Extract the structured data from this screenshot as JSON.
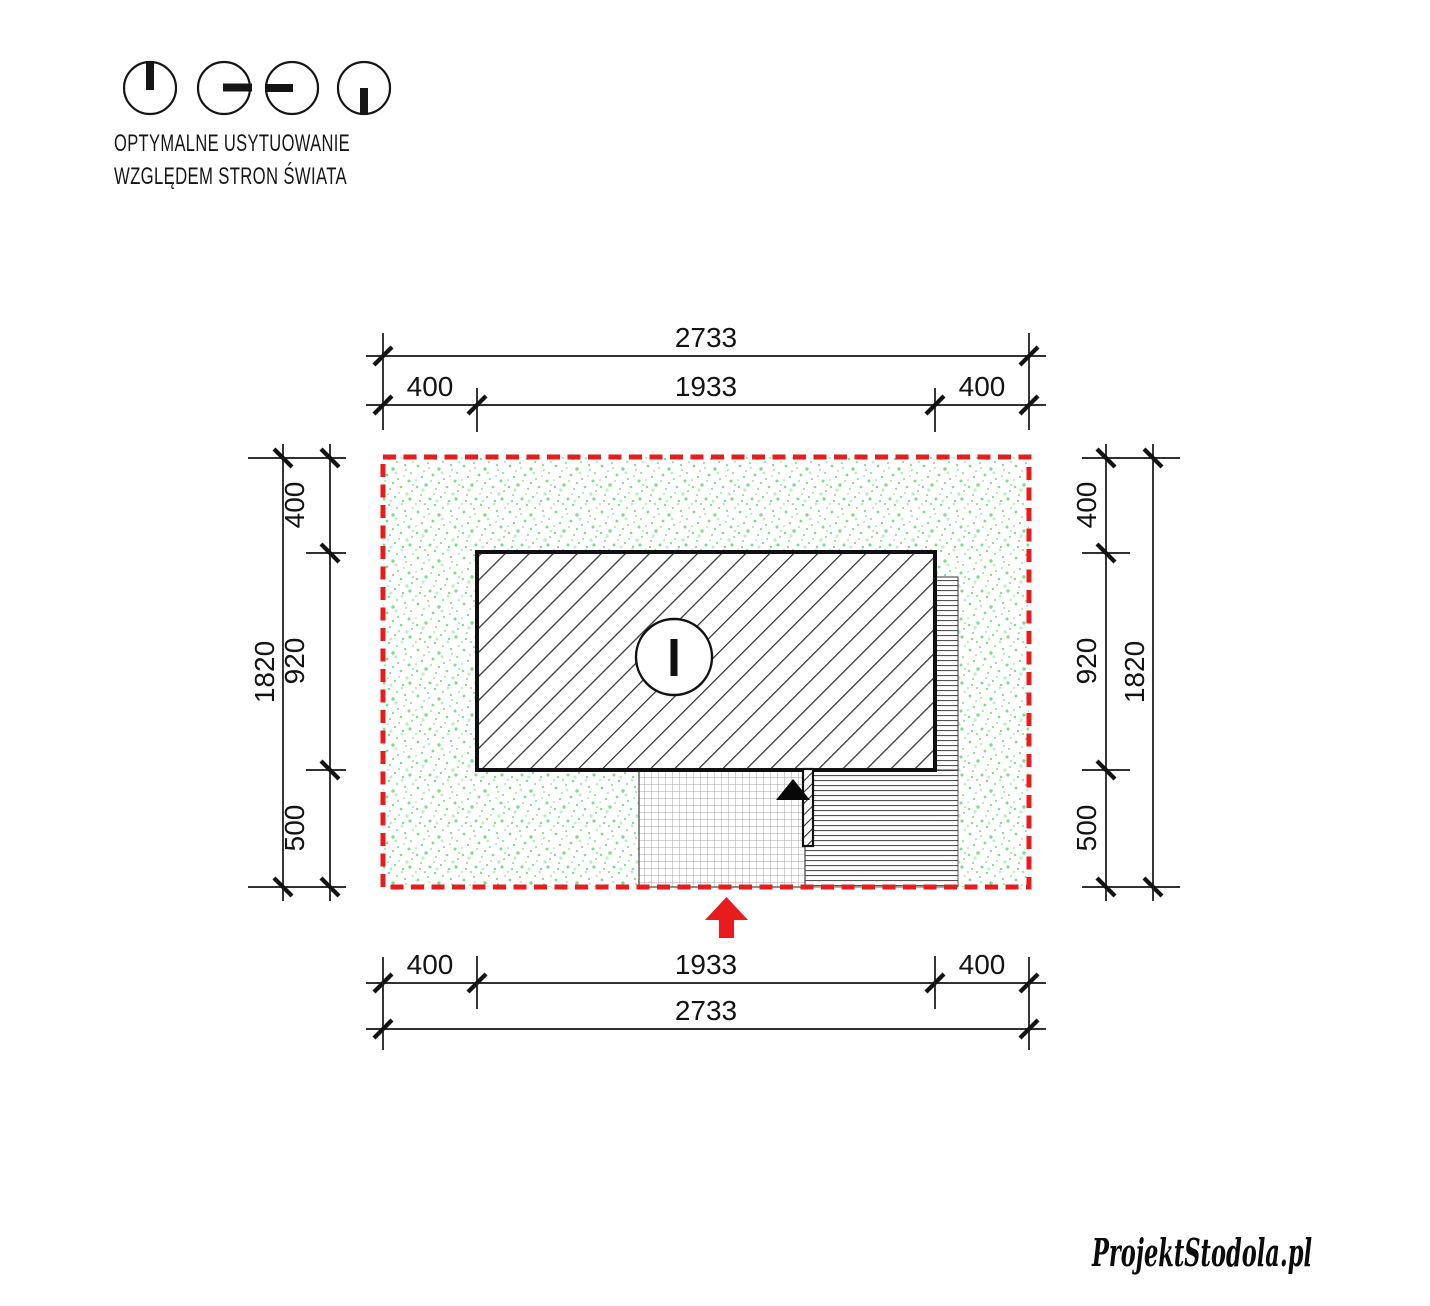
{
  "orientation_legend": {
    "icon_names": [
      "clock-hand-up-icon",
      "clock-hand-right-icon",
      "clock-hand-left-icon",
      "clock-hand-down-icon"
    ],
    "title_line1": "OPTYMALNE USYTUOWANIE",
    "title_line2": "WZGLĘDEM STRON ŚWIATA"
  },
  "site_plan": {
    "dimensions_top": {
      "total": "2733",
      "segments": [
        "400",
        "1933",
        "400"
      ]
    },
    "dimensions_bottom": {
      "segments": [
        "400",
        "1933",
        "400"
      ],
      "total": "2733"
    },
    "dimensions_left": {
      "total": "1820",
      "segments": [
        "400",
        "920",
        "500"
      ]
    },
    "dimensions_right": {
      "segments": [
        "400",
        "920",
        "500"
      ],
      "total": "1820"
    },
    "symbols": {
      "entrance_marker": "black-triangle-icon",
      "entrance_direction": "red-arrow-up-icon",
      "chimney": "circle-with-bar-icon"
    }
  },
  "colors": {
    "plot_boundary_red": "#e81c1c",
    "entrance_arrow_red": "#e81c1c",
    "greenery_dot": "#7edd86",
    "greenery_dot_light": "#bdeec4",
    "drawing_ink": "#131313"
  },
  "footer": {
    "logo_text": "ProjektStodola.pl"
  }
}
